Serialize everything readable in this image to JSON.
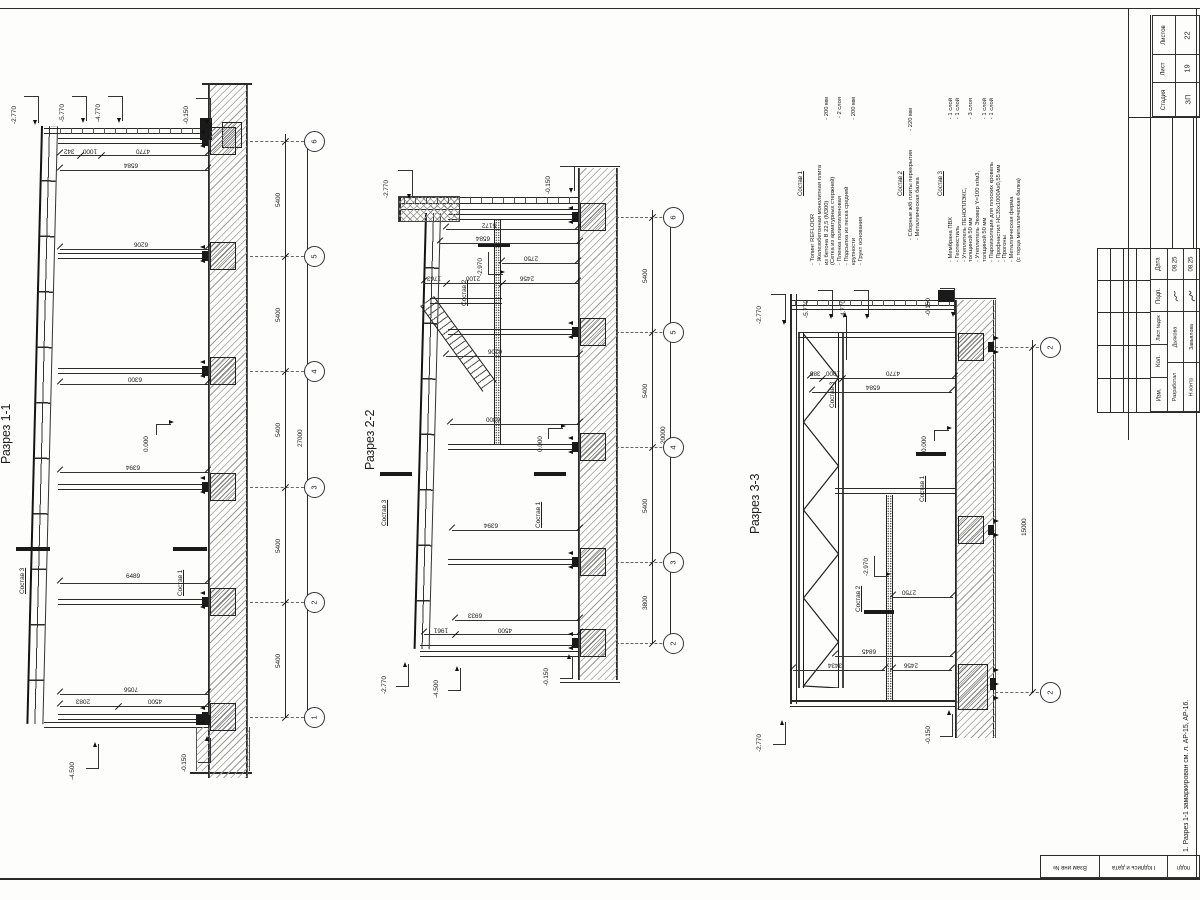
{
  "stamp": {
    "stage_label": "Стадия",
    "sheet_label": "Лист",
    "sheets_label": "Листов",
    "stage": "ЗП",
    "sheet_no": "19",
    "sheets_total": "22",
    "rev_headers": [
      "Дата",
      "Подп.",
      "Лист №док",
      "Кол.",
      "Изм."
    ],
    "sign_rows": [
      {
        "role": "Разработал",
        "name": "Дьякова",
        "date": "08.25"
      },
      {
        "role": "Н.контр",
        "name": "Завьялова",
        "date": "08.25"
      }
    ],
    "side_cells": [
      "Взам инв №",
      "Подпись и дата",
      "подп"
    ],
    "note": "1. Разрез 1-1 замаркирован см. л. АР-15, АР-16."
  },
  "sections": [
    {
      "title": "Разрез 1-1"
    },
    {
      "title": "Разрез 2-2"
    },
    {
      "title": "Разрез 3-3"
    }
  ],
  "compositions": [
    {
      "header": "Состав 1",
      "items": [
        {
          "t": "- Топинг REFLOOR",
          "v": ""
        },
        {
          "t": "- Железобетонная монолитная плита",
          "v": ""
        },
        {
          "t": "  из бетона В 22,5 (М300)",
          "v": "- 200 мм"
        },
        {
          "t": "  (Сетка из арматурных стержней)",
          "v": ""
        },
        {
          "t": "- Пленка полиэтиленовая",
          "v": "- 2 слоя"
        },
        {
          "t": "- Подсыпка из песка средней",
          "v": ""
        },
        {
          "t": "  крупности",
          "v": "- 200 мм"
        },
        {
          "t": "- Грунт основания",
          "v": ""
        }
      ]
    },
    {
      "header": "Состав 2",
      "items": [
        {
          "t": "- Сборные ж/б плиты перекрытия",
          "v": "- 220 мм"
        },
        {
          "t": "- Металлическая балка",
          "v": ""
        }
      ]
    },
    {
      "header": "Состав 3",
      "items": [
        {
          "t": "- Мембрана ПВХ",
          "v": "- 1 слой"
        },
        {
          "t": "- Геотекстиль",
          "v": "- 1 слой"
        },
        {
          "t": "- Утеплитель ПЕНОПЛЭКС,",
          "v": ""
        },
        {
          "t": "  толщиной 50 мм",
          "v": "- 3 слоя"
        },
        {
          "t": "- Утеплитель Эковер Y=100 кг/м3,",
          "v": ""
        },
        {
          "t": "  толщиной 50 мм",
          "v": "- 1 слой"
        },
        {
          "t": "- Пароизоляция для плоских кровель",
          "v": "- 1 слой"
        },
        {
          "t": "- Профнастил НС35х1000Ах0,55 мм",
          "v": ""
        },
        {
          "t": "- Прогоны",
          "v": ""
        },
        {
          "t": "- Металлическая ферма",
          "v": ""
        },
        {
          "t": "  (с торца металлическая балка)",
          "v": ""
        }
      ]
    }
  ],
  "bubbles": [
    {
      "label": "6",
      "x": 304,
      "y": 131
    },
    {
      "label": "5",
      "x": 304,
      "y": 246
    },
    {
      "label": "4",
      "x": 304,
      "y": 361
    },
    {
      "label": "3",
      "x": 304,
      "y": 477
    },
    {
      "label": "2",
      "x": 304,
      "y": 592
    },
    {
      "label": "1",
      "x": 304,
      "y": 707
    },
    {
      "label": "6",
      "x": 663,
      "y": 207
    },
    {
      "label": "5",
      "x": 663,
      "y": 322
    },
    {
      "label": "4",
      "x": 663,
      "y": 437
    },
    {
      "label": "3",
      "x": 663,
      "y": 552
    },
    {
      "label": "2",
      "x": 663,
      "y": 633
    },
    {
      "label": "2",
      "x": 1040,
      "y": 337
    },
    {
      "label": "2",
      "x": 1040,
      "y": 682
    }
  ],
  "annotations": [
    {
      "t": "Разрез 1-1",
      "x": 0,
      "y": 464,
      "o": "v",
      "s": 12.5
    },
    {
      "t": "-2.770",
      "x": 12,
      "y": 124,
      "o": "v"
    },
    {
      "t": "-5.770",
      "x": 60,
      "y": 122,
      "o": "v"
    },
    {
      "t": "-4.770",
      "x": 96,
      "y": 122,
      "o": "v"
    },
    {
      "t": "-0.150",
      "x": 184,
      "y": 124,
      "o": "v"
    },
    {
      "t": "5400",
      "x": 276,
      "y": 207,
      "o": "v"
    },
    {
      "t": "5400",
      "x": 276,
      "y": 322,
      "o": "v"
    },
    {
      "t": "5400",
      "x": 276,
      "y": 437,
      "o": "v"
    },
    {
      "t": "5400",
      "x": 276,
      "y": 553,
      "o": "v"
    },
    {
      "t": "5400",
      "x": 276,
      "y": 668,
      "o": "v"
    },
    {
      "t": "27000",
      "x": 298,
      "y": 447,
      "o": "v"
    },
    {
      "t": "342",
      "x": 64,
      "y": 147,
      "o": "u"
    },
    {
      "t": "1000",
      "x": 83,
      "y": 147,
      "o": "u"
    },
    {
      "t": "4770",
      "x": 136,
      "y": 147,
      "o": "u"
    },
    {
      "t": "6584",
      "x": 124,
      "y": 161,
      "o": "u"
    },
    {
      "t": "6206",
      "x": 134,
      "y": 240,
      "o": "u"
    },
    {
      "t": "6300",
      "x": 128,
      "y": 375,
      "o": "u"
    },
    {
      "t": "6394",
      "x": 126,
      "y": 463,
      "o": "u"
    },
    {
      "t": "6489",
      "x": 126,
      "y": 574,
      "o": "n"
    },
    {
      "t": "7056",
      "x": 124,
      "y": 685,
      "o": "u"
    },
    {
      "t": "2083",
      "x": 76,
      "y": 697,
      "o": "u"
    },
    {
      "t": "4500",
      "x": 148,
      "y": 697,
      "o": "u"
    },
    {
      "t": "0.000",
      "x": 144,
      "y": 452,
      "o": "v"
    },
    {
      "t": "Состав 3",
      "x": 20,
      "y": 594,
      "o": "v",
      "u": true
    },
    {
      "t": "Состав 1",
      "x": 178,
      "y": 596,
      "o": "v",
      "u": true
    },
    {
      "t": "-4.500",
      "x": 70,
      "y": 780,
      "o": "v"
    },
    {
      "t": "-0.150",
      "x": 182,
      "y": 772,
      "o": "v"
    },
    {
      "t": "Разрез 2-2",
      "x": 364,
      "y": 470,
      "o": "v",
      "s": 12.5
    },
    {
      "t": "-2.770",
      "x": 384,
      "y": 198,
      "o": "v"
    },
    {
      "t": "-0.150",
      "x": 546,
      "y": 194,
      "o": "v"
    },
    {
      "t": "5400",
      "x": 643,
      "y": 283,
      "o": "v"
    },
    {
      "t": "5400",
      "x": 643,
      "y": 398,
      "o": "v"
    },
    {
      "t": "5400",
      "x": 643,
      "y": 513,
      "o": "v"
    },
    {
      "t": "3800",
      "x": 643,
      "y": 610,
      "o": "v"
    },
    {
      "t": "20000",
      "x": 661,
      "y": 444,
      "o": "v"
    },
    {
      "t": "5172",
      "x": 482,
      "y": 221,
      "o": "u"
    },
    {
      "t": "6584",
      "x": 476,
      "y": 234,
      "o": "u"
    },
    {
      "t": "2750",
      "x": 524,
      "y": 254,
      "o": "u"
    },
    {
      "t": "1763",
      "x": 427,
      "y": 274,
      "o": "u"
    },
    {
      "t": "2100",
      "x": 466,
      "y": 274,
      "o": "u"
    },
    {
      "t": "2456",
      "x": 520,
      "y": 274,
      "o": "u"
    },
    {
      "t": "-2.970",
      "x": 478,
      "y": 276,
      "o": "v"
    },
    {
      "t": "Состав 2",
      "x": 462,
      "y": 306,
      "o": "v",
      "u": true
    },
    {
      "t": "6206",
      "x": 488,
      "y": 347,
      "o": "u"
    },
    {
      "t": "6300",
      "x": 486,
      "y": 415,
      "o": "u"
    },
    {
      "t": "0.000",
      "x": 538,
      "y": 452,
      "o": "v"
    },
    {
      "t": "Состав 3",
      "x": 382,
      "y": 526,
      "o": "v",
      "u": true
    },
    {
      "t": "Состав 1",
      "x": 536,
      "y": 528,
      "o": "v",
      "u": true
    },
    {
      "t": "6394",
      "x": 484,
      "y": 521,
      "o": "u"
    },
    {
      "t": "6933",
      "x": 468,
      "y": 611,
      "o": "u"
    },
    {
      "t": "1961",
      "x": 434,
      "y": 626,
      "o": "u"
    },
    {
      "t": "4500",
      "x": 498,
      "y": 626,
      "o": "u"
    },
    {
      "t": "-2.770",
      "x": 382,
      "y": 694,
      "o": "v"
    },
    {
      "t": "-4.500",
      "x": 434,
      "y": 698,
      "o": "v"
    },
    {
      "t": "-0.150",
      "x": 544,
      "y": 686,
      "o": "v"
    },
    {
      "t": "Разрез 3-3",
      "x": 749,
      "y": 534,
      "o": "v",
      "s": 12.5
    },
    {
      "t": "-2.770",
      "x": 757,
      "y": 324,
      "o": "v"
    },
    {
      "t": "-5.770",
      "x": 804,
      "y": 318,
      "o": "v"
    },
    {
      "t": "-4.770",
      "x": 841,
      "y": 318,
      "o": "v"
    },
    {
      "t": "-0.150",
      "x": 926,
      "y": 316,
      "o": "v"
    },
    {
      "t": "15000",
      "x": 1022,
      "y": 536,
      "o": "v"
    },
    {
      "t": "385",
      "x": 810,
      "y": 369,
      "o": "u"
    },
    {
      "t": "1000",
      "x": 826,
      "y": 369,
      "o": "u"
    },
    {
      "t": "4770",
      "x": 886,
      "y": 369,
      "o": "u"
    },
    {
      "t": "6584",
      "x": 866,
      "y": 383,
      "o": "u"
    },
    {
      "t": "Состав 3",
      "x": 830,
      "y": 408,
      "o": "v",
      "u": true
    },
    {
      "t": "0.000",
      "x": 922,
      "y": 452,
      "o": "v"
    },
    {
      "t": "Состав 1",
      "x": 920,
      "y": 502,
      "o": "v",
      "u": true
    },
    {
      "t": "-2.970",
      "x": 864,
      "y": 576,
      "o": "v"
    },
    {
      "t": "Состав 2",
      "x": 856,
      "y": 612,
      "o": "v",
      "u": true
    },
    {
      "t": "2750",
      "x": 902,
      "y": 588,
      "o": "u"
    },
    {
      "t": "6845",
      "x": 862,
      "y": 647,
      "o": "u"
    },
    {
      "t": "3434",
      "x": 828,
      "y": 661,
      "o": "u"
    },
    {
      "t": "2456",
      "x": 904,
      "y": 661,
      "o": "u"
    },
    {
      "t": "-2.770",
      "x": 757,
      "y": 752,
      "o": "v"
    },
    {
      "t": "-0.150",
      "x": 926,
      "y": 744,
      "o": "v"
    }
  ]
}
